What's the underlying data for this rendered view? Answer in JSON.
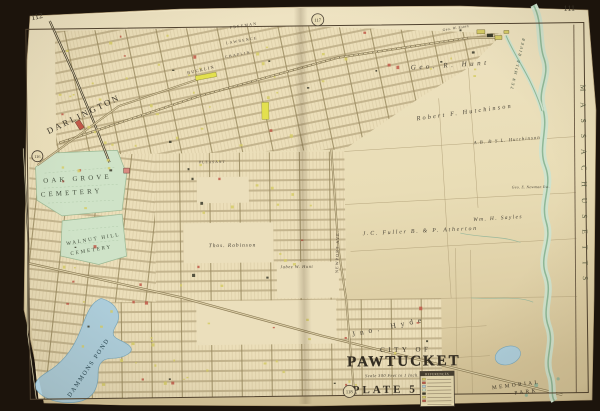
{
  "pg": {
    "top_left": "112",
    "top_right": "111"
  },
  "refs": {
    "top": "117",
    "bottom": "118",
    "left": "116"
  },
  "title": {
    "line1": "CITY OF",
    "line2": "PAWTUCKET",
    "scale": "Scale 300 Feet to 1 Inch.",
    "plate": "PLATE 5"
  },
  "legend": {
    "title": "REFERENCES"
  },
  "places": {
    "darlington": "DARLINGTON",
    "oak_grove_1": "OAK GROVE",
    "oak_grove_2": "CEMETERY",
    "walnut_1": "WALNUT HILL",
    "walnut_2": "CEMETERY",
    "dammons_pond": "DAMMONS POND",
    "memorial_1": "MEMORIAL",
    "memorial_2": "PARK",
    "massachusetts": "MASSACHUSETTS",
    "river": "TEN MILE RIVER",
    "jno_hyde": "Jno. Hyde"
  },
  "owners": {
    "geo_r_hunt": "Geo. R. Hunt",
    "robert_f_hutchinson": "Robert F. Hutchinson",
    "ab_sl_hutchinson": "A.B. & S.L. Hutchinson",
    "geo_e_newman": "Geo. E. Newman Est.",
    "wm_h_sayles": "Wm. H. Sayles",
    "jc_fuller_atherton": "J.C. Fuller  B. & P. Atherton",
    "thos_robinson": "Thos. Robinson",
    "jabez_w_hunt": "Jabez W. Hunt",
    "geo_w_esten": "Geo. W. Esten"
  },
  "streets": {
    "freeman": "FREEMAN",
    "lawrence": "LAWRENCE",
    "chaplin": "CHAPLIN",
    "bucklin": "BUCKLIN",
    "pleasant": "PLEASANT",
    "newport_ave": "NEWPORT AVE."
  },
  "colors": {
    "paper": "#e9ddb6",
    "water_blue": "#aecfdd",
    "river_green": "#8fb896",
    "cemetery_green": "#cfe3c8",
    "building_yellow": "#d6cc66",
    "building_red": "#c05848",
    "ink": "#3a3428"
  }
}
